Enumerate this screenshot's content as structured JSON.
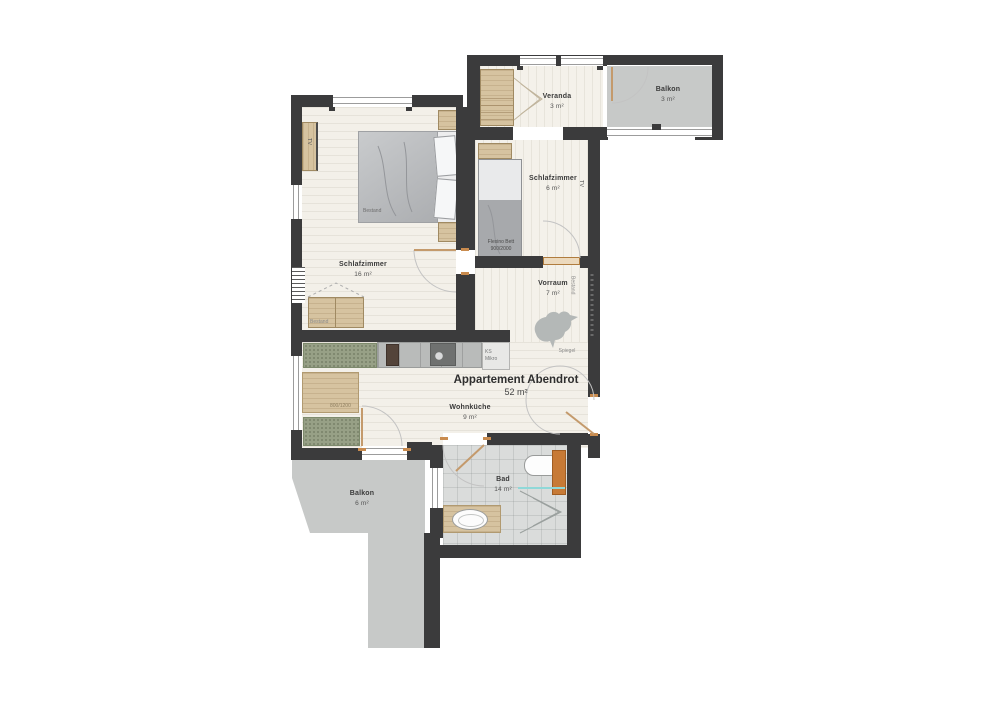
{
  "title": {
    "name": "Appartement Abendrot",
    "area": "52 m²"
  },
  "rooms": {
    "schlafzimmer_gross": {
      "label": "Schlafzimmer",
      "area": "16 m²"
    },
    "schlafzimmer_klein": {
      "label": "Schlafzimmer",
      "area": "6 m²"
    },
    "veranda": {
      "label": "Veranda",
      "area": "3 m²"
    },
    "balkon_oben": {
      "label": "Balkon",
      "area": "3 m²"
    },
    "vorraum": {
      "label": "Vorraum",
      "area": "7 m²"
    },
    "wohnkueche": {
      "label": "Wohnküche",
      "area": "9 m²"
    },
    "bad": {
      "label": "Bad",
      "area": "14 m²"
    },
    "balkon_unten": {
      "label": "Balkon",
      "area": "6 m²"
    }
  },
  "furniture": {
    "tv_schrank": "TV",
    "tv_wand": "TV",
    "bett_bestand": "Bestand",
    "schrank_bestand": "Bestand",
    "vorraum_bestand": "Bestand",
    "flexino_zeile1": "Flexino Bett",
    "flexino_zeile2": "900/2000",
    "tisch_mass": "800/1200",
    "kuehlschrank": "KS",
    "mikrowelle": "Mikro",
    "spiegel": "Spiegel"
  },
  "colors": {
    "wall": "#3b3b3c",
    "floor": "#f3f0e9",
    "balcony": "#c7c9c8",
    "wood_accent": "#c77a36",
    "bench_green": "#97a086"
  }
}
